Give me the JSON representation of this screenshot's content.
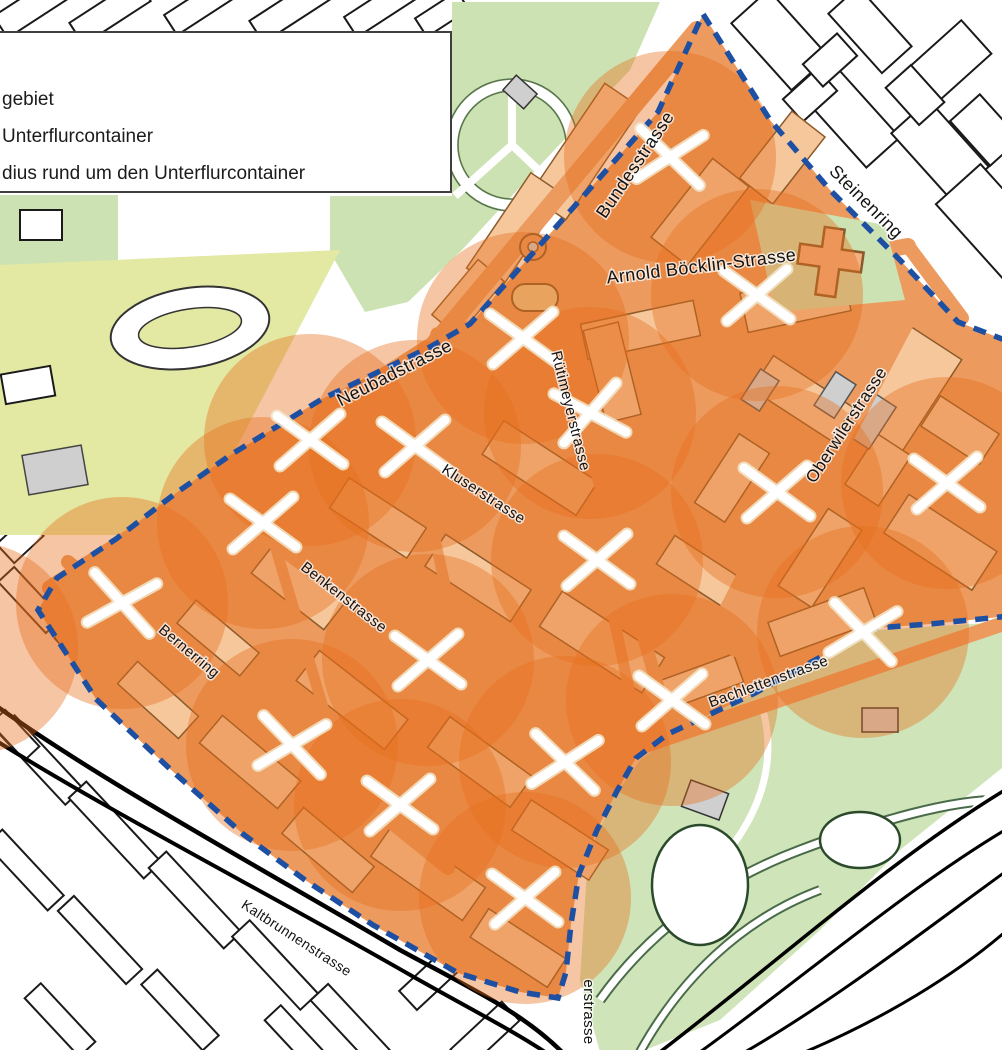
{
  "legend": {
    "items": [
      {
        "symbol": "boundary-dashed-line",
        "label": "gebiet"
      },
      {
        "symbol": "x-marker",
        "label": "Unterflurcontainer"
      },
      {
        "symbol": "radius-circle",
        "label": "dius rund um den Unterflurcontainer"
      }
    ]
  },
  "map": {
    "radius_px": 106,
    "colors": {
      "pilot_road": "#EC9A5E",
      "pilot_block": "#F6C79B",
      "block_outline": "#8A5A2A",
      "radius_fill": "#E76F1C",
      "boundary_blue": "#1D4FA3",
      "park_green": "#CDE2B2",
      "field_yellow": "#E3E8A3",
      "zoo_green": "#CFE4B8",
      "building_gray": "#CFCFCF",
      "marker_white": "#FFFFFF"
    },
    "radius_opacity": "0.40",
    "street_labels": [
      {
        "name": "Bundesstrasse",
        "x": 640,
        "y": 168,
        "rotate": -56,
        "size": 18
      },
      {
        "name": "Steinenring",
        "x": 862,
        "y": 206,
        "rotate": 45,
        "size": 18
      },
      {
        "name": "Arnold Böcklin-Strasse",
        "x": 702,
        "y": 272,
        "rotate": -7,
        "size": 18
      },
      {
        "name": "Neubadstrasse",
        "x": 397,
        "y": 378,
        "rotate": -27,
        "size": 18
      },
      {
        "name": "Rütimeyerstrasse",
        "x": 566,
        "y": 412,
        "rotate": 76,
        "size": 15
      },
      {
        "name": "Oberwilerstrasse",
        "x": 851,
        "y": 428,
        "rotate": -57,
        "size": 17
      },
      {
        "name": "Kluserstrasse",
        "x": 481,
        "y": 498,
        "rotate": 33,
        "size": 15
      },
      {
        "name": "Benkenstrasse",
        "x": 341,
        "y": 601,
        "rotate": 38,
        "size": 15
      },
      {
        "name": "Bernerring",
        "x": 186,
        "y": 655,
        "rotate": 40,
        "size": 15
      },
      {
        "name": "Bachlettenstrasse",
        "x": 770,
        "y": 686,
        "rotate": -20,
        "size": 15
      },
      {
        "name": "Kaltbrunnenstrasse",
        "x": 294,
        "y": 942,
        "rotate": 33,
        "size": 14
      },
      {
        "name": "erstrasse",
        "x": 584,
        "y": 1012,
        "rotate": 90,
        "size": 15
      }
    ],
    "containers": [
      {
        "x": 670,
        "y": 157,
        "rot": 8
      },
      {
        "x": 757,
        "y": 295,
        "rot": 0
      },
      {
        "x": 523,
        "y": 338,
        "rot": 0
      },
      {
        "x": 590,
        "y": 413,
        "rot": -8
      },
      {
        "x": 947,
        "y": 483,
        "rot": 0
      },
      {
        "x": 777,
        "y": 492,
        "rot": 0
      },
      {
        "x": 310,
        "y": 440,
        "rot": 0
      },
      {
        "x": 415,
        "y": 446,
        "rot": 0
      },
      {
        "x": 263,
        "y": 523,
        "rot": 0
      },
      {
        "x": 122,
        "y": 603,
        "rot": 12
      },
      {
        "x": 597,
        "y": 560,
        "rot": 0
      },
      {
        "x": 428,
        "y": 660,
        "rot": 0
      },
      {
        "x": 292,
        "y": 745,
        "rot": 10
      },
      {
        "x": 400,
        "y": 805,
        "rot": 0
      },
      {
        "x": 565,
        "y": 762,
        "rot": 8
      },
      {
        "x": 525,
        "y": 898,
        "rot": 0
      },
      {
        "x": 863,
        "y": 632,
        "rot": 10
      },
      {
        "x": 672,
        "y": 700,
        "rot": 0
      }
    ],
    "extra_radius_centers": [
      {
        "x": -28,
        "y": 648
      }
    ]
  }
}
